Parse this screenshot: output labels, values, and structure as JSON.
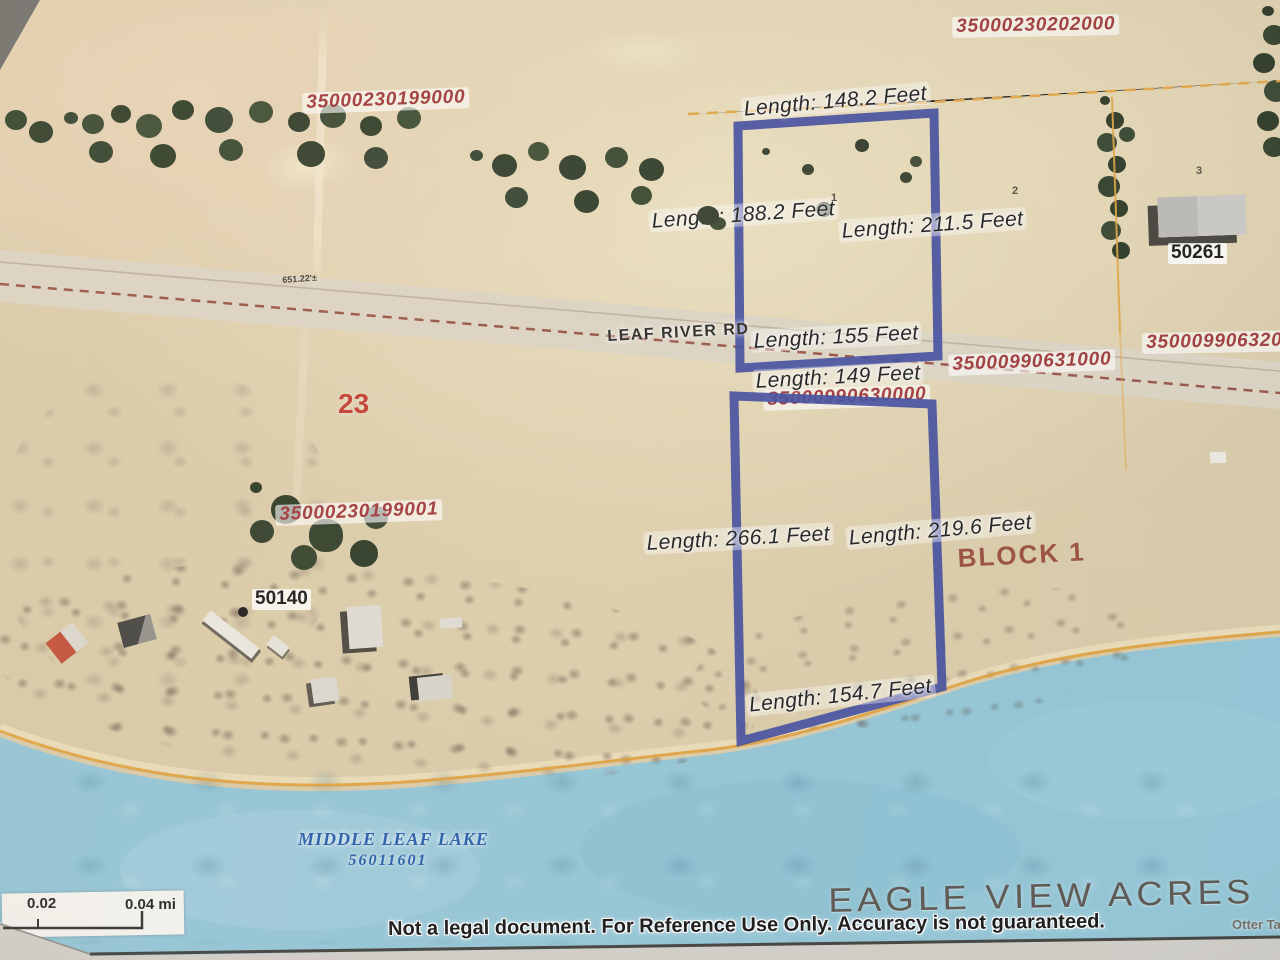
{
  "map_title": "EAGLE VIEW ACRES",
  "attribution": "Otter Ta",
  "disclaimer": "Not a legal document. For Reference Use Only. Accuracy is not guaranteed.",
  "road": {
    "name": "LEAF RIVER RD",
    "survey_distance": "651.22'±"
  },
  "lake": {
    "name": "MIDDLE LEAF LAKE",
    "id": "56011601"
  },
  "scale_bar": {
    "mid_label": "0.02",
    "end_label": "0.04 mi"
  },
  "section_number": "23",
  "block_label": "BLOCK 1",
  "parcel_ids": {
    "nw": "35000230199000",
    "ne": "35000230202000",
    "sw": "35000230199001",
    "road_center": "35000990630000",
    "road_east": "35000990631000",
    "far_east": "35000990632000"
  },
  "lot_numbers": {
    "lot1": "1",
    "lot2": "2",
    "lot3": "3"
  },
  "addresses": {
    "west": "50140",
    "east": "50261"
  },
  "highlighted_parcels": {
    "north": {
      "top": "Length: 148.2 Feet",
      "left": "Length: 188.2 Feet",
      "right": "Length: 211.5 Feet",
      "bottom": "Length: 155 Feet"
    },
    "south": {
      "top": "Length: 149 Feet",
      "left": "Length: 266.1 Feet",
      "right": "Length: 219.6 Feet",
      "bottom": "Length: 154.7 Feet"
    }
  },
  "colors": {
    "parcel_outline": "#3c479b",
    "parcel_id_text": "#9c3434",
    "water": "#8fc3d4",
    "boundary_orange": "#e2a23c",
    "road_dash": "#8a3a2a",
    "lake_label": "#1f57a8",
    "title_text": "#544f49"
  }
}
